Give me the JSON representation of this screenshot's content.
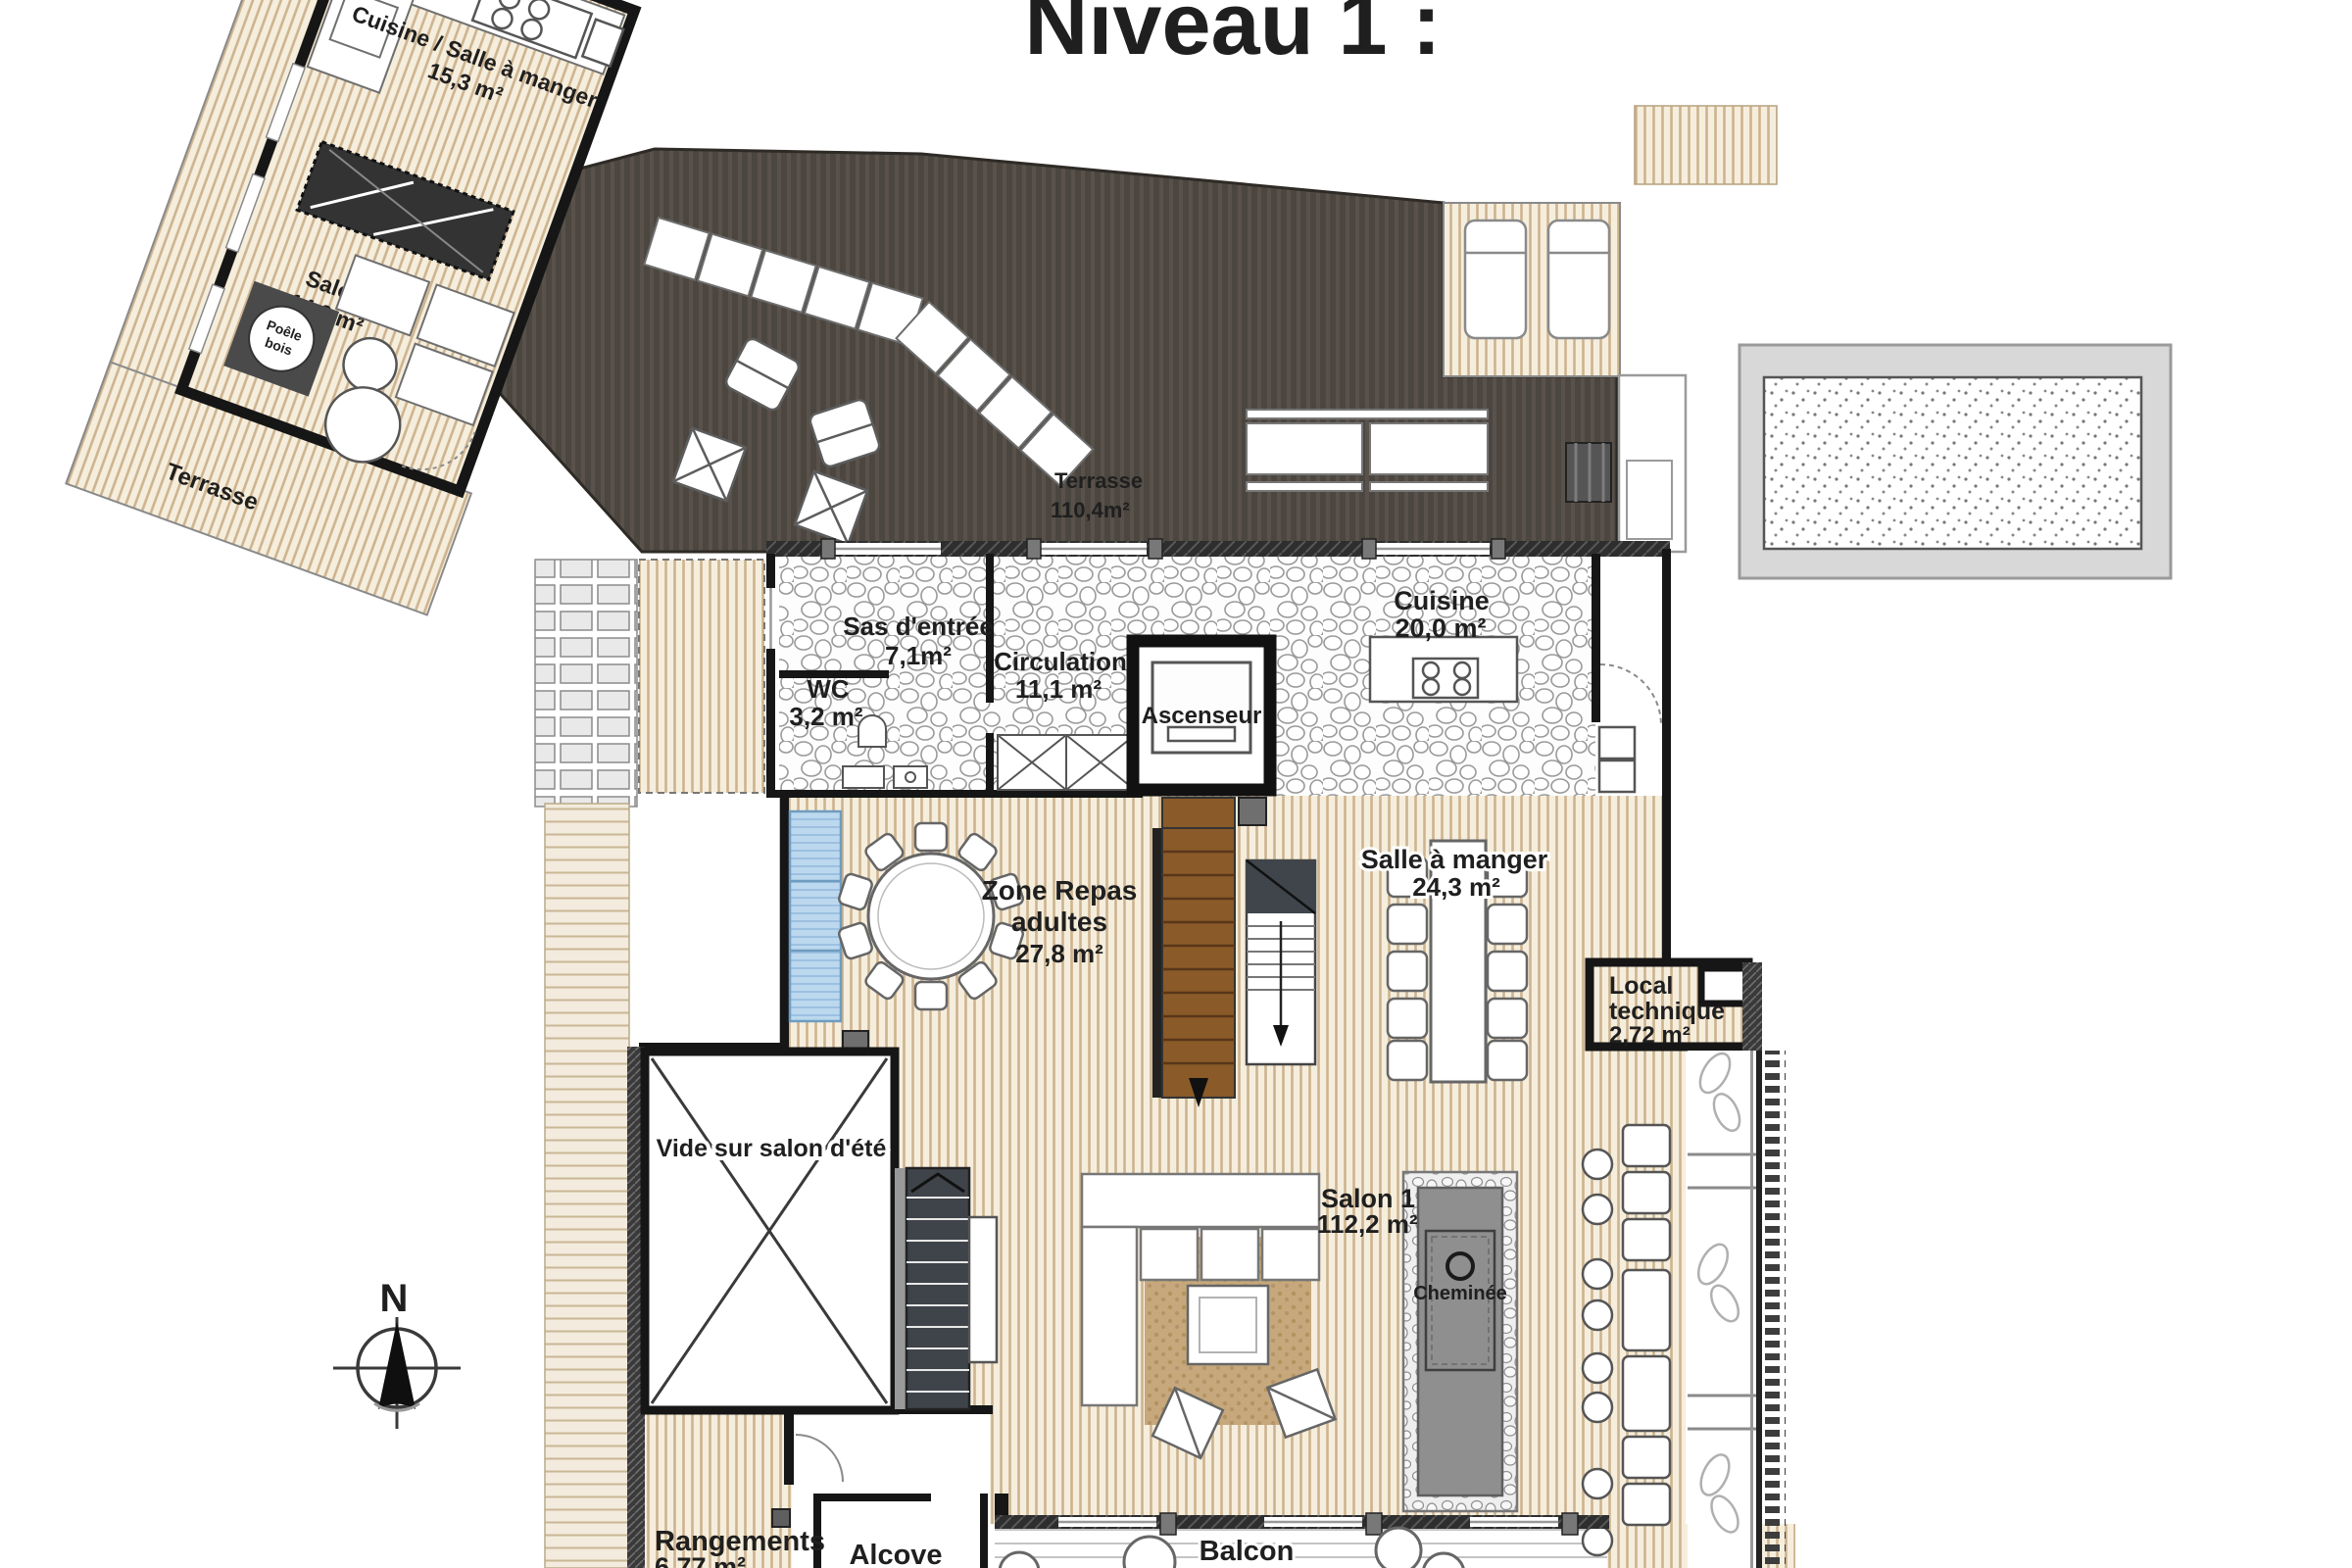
{
  "title": "Niveau 1 :",
  "compass": {
    "label": "N"
  },
  "annex": {
    "kitchen_dining": {
      "lines": [
        "Cuisine / Salle à manger",
        "15,3 m²"
      ]
    },
    "salon": {
      "lines": [
        "Salon",
        "14,0 m²"
      ]
    },
    "stove": {
      "lines": [
        "Poêle",
        "bois"
      ]
    },
    "terrace": {
      "label": "Terrasse"
    }
  },
  "terrace": {
    "lines": [
      "Terrasse",
      "110,4m²"
    ]
  },
  "rooms": {
    "entry": {
      "lines": [
        "Sas d'entrée",
        "7,1m²"
      ]
    },
    "wc": {
      "lines": [
        "WC",
        "3,2 m²"
      ]
    },
    "circulation": {
      "lines": [
        "Circulation",
        "11,1 m²"
      ]
    },
    "elevator": {
      "label": "Ascenseur"
    },
    "kitchen": {
      "lines": [
        "Cuisine",
        "20,0 m²"
      ]
    },
    "dining_adults": {
      "lines": [
        "Zone Repas",
        "adultes",
        "27,8 m²"
      ]
    },
    "dining": {
      "lines": [
        "Salle à manger",
        "24,3 m²"
      ]
    },
    "technical": {
      "lines": [
        "Local",
        "technique",
        "2,72 m²"
      ]
    },
    "void": {
      "label": "Vide sur salon d'été"
    },
    "living": {
      "lines": [
        "Salon 1",
        "112,2 m²"
      ]
    },
    "fireplace": {
      "label": "Cheminée"
    },
    "storage": {
      "lines": [
        "Rangements",
        "6,77 m²"
      ]
    },
    "alcove": {
      "label": "Alcove"
    },
    "balcony": {
      "label": "Balcon"
    }
  },
  "colors": {
    "deck_dark": "#4b4740",
    "floor_cream": "#f6eedd",
    "wood_stripe": "#cdb38f",
    "wall": "#161616",
    "stair_brown": "#8a5a28",
    "sofa_blue": "#bcd8ee",
    "fireplace_gray": "#8f8f8f"
  }
}
